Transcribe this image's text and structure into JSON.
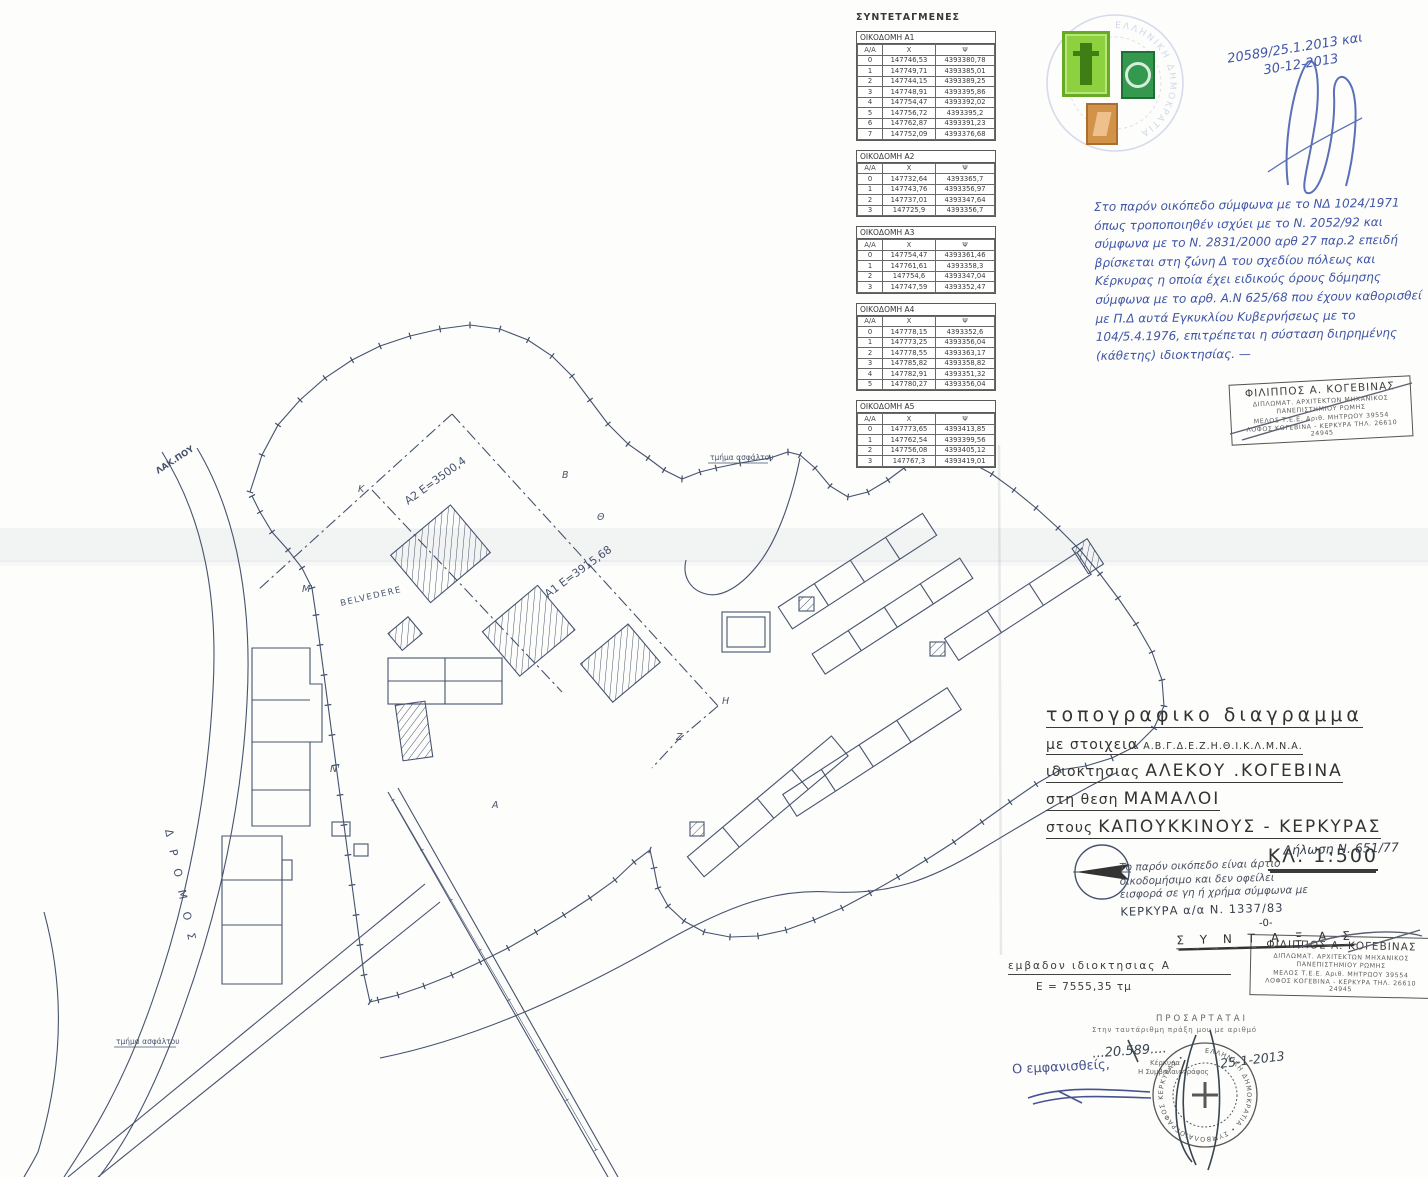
{
  "coordinates_panel": {
    "title": "ΣΥΝΤΕΤΑΓΜΕΝΕΣ",
    "columns": [
      "Α/Α",
      "Χ",
      "Ψ"
    ],
    "tables": [
      {
        "name": "ΟΙΚΟΔΟΜΗ Α1",
        "rows": [
          [
            "0",
            "147746,53",
            "4393380,78"
          ],
          [
            "1",
            "147749,71",
            "4393385,01"
          ],
          [
            "2",
            "147744,15",
            "4393389,25"
          ],
          [
            "3",
            "147748,91",
            "4393395,86"
          ],
          [
            "4",
            "147754,47",
            "4393392,02"
          ],
          [
            "5",
            "147756,72",
            "4393395,2"
          ],
          [
            "6",
            "147762,87",
            "4393391,23"
          ],
          [
            "7",
            "147752,09",
            "4393376,68"
          ]
        ]
      },
      {
        "name": "ΟΙΚΟΔΟΜΗ Α2",
        "rows": [
          [
            "0",
            "147732,64",
            "4393365,7"
          ],
          [
            "1",
            "147743,76",
            "4393356,97"
          ],
          [
            "2",
            "147737,01",
            "4393347,64"
          ],
          [
            "3",
            "147725,9",
            "4393356,7"
          ]
        ]
      },
      {
        "name": "ΟΙΚΟΔΟΜΗ Α3",
        "rows": [
          [
            "0",
            "147754,47",
            "4393361,46"
          ],
          [
            "1",
            "147761,61",
            "4393358,3"
          ],
          [
            "2",
            "147754,6",
            "4393347,04"
          ],
          [
            "3",
            "147747,59",
            "4393352,47"
          ]
        ]
      },
      {
        "name": "ΟΙΚΟΔΟΜΗ Α4",
        "rows": [
          [
            "0",
            "147778,15",
            "4393352,6"
          ],
          [
            "1",
            "147773,25",
            "4393356,04"
          ],
          [
            "2",
            "147778,55",
            "4393363,17"
          ],
          [
            "3",
            "147785,82",
            "4393358,82"
          ],
          [
            "4",
            "147782,91",
            "4393351,32"
          ],
          [
            "5",
            "147780,27",
            "4393356,04"
          ]
        ]
      },
      {
        "name": "ΟΙΚΟΔΟΜΗ Α5",
        "rows": [
          [
            "0",
            "147773,65",
            "4393413,85"
          ],
          [
            "1",
            "147762,54",
            "4393399,56"
          ],
          [
            "2",
            "147756,08",
            "4393405,12"
          ],
          [
            "3",
            "147767,3",
            "4393419,01"
          ]
        ]
      }
    ]
  },
  "annotations": {
    "registry_line1": "20589/25.1.2013 και",
    "registry_line2": "30-12-2013",
    "legal_note_lines": [
      "Στο παρόν οικόπεδο σύμφωνα με το ΝΔ 1024/1971",
      "όπως τροποποιηθέν ισχύει με το Ν. 2052/92 και",
      "σύμφωνα με το Ν. 2831/2000 αρθ 27 παρ.2 επειδή",
      "βρίσκεται στη ζώνη Δ του σχεδίου πόλεως και",
      "Κέρκυρας η οποία έχει ειδικούς όρους δόμησης",
      "σύμφωνα με το αρθ. Α.Ν 625/68 που έχουν καθορισθεί",
      "με Π.Δ αυτά Εγκυκλίου Κυβερνήσεως με το",
      "104/5.4.1976, επιτρέπεται η σύσταση διηρημένης",
      "(κάθετης) ιδιοκτησίας. —"
    ]
  },
  "architect_stamp": {
    "line1": "ΦΙΛΙΠΠΟΣ Α. ΚΟΓΕΒΙΝΑΣ",
    "line2": "ΔΙΠΛΩΜΑΤ. ΑΡΧΙΤΕΚΤΩΝ ΜΗΧΑΝΙΚΟΣ",
    "line3": "ΠΑΝΕΠΙΣΤΗΜΙΟΥ ΡΩΜΗΣ",
    "line4": "ΜΕΛΟΣ Τ.Ε.Ε. Αριθ. ΜΗΤΡΩΟΥ 39554",
    "line5": "ΛΟΦΟΣ ΚΟΓΕΒΙΝΑ - ΚΕΡΚΥΡΑ ΤΗΛ. 26610 24945"
  },
  "title_block": {
    "line1": "τοπογραφικο  διαγραμμα",
    "line2_prefix": "με στοιχεια",
    "line2_letters": "Α.Β.Γ.Δ.Ε.Ζ.Η.Θ.Ι.Κ.Λ.Μ.Ν.Α.",
    "line3_prefix": "ιδιοκτησιας",
    "line3": "ΑΛΕΚΟΥ .ΚΟΓΕΒΙΝΑ",
    "line4_prefix": "στη θεση",
    "line4": "ΜΑΜΑΛΟΙ",
    "line5_prefix": "στους",
    "line5": "ΚΑΠΟΥΚΚΙΝΟΥΣ - ΚΕΡΚΥΡΑΣ",
    "scale": "ΚΛ. 1:500"
  },
  "declaration": {
    "heading": "Δήλωση Ν. 651/77",
    "lines": [
      "Το παρόν οικόπεδο είναι άρτιο",
      "οικοδομήσιμο και δεν οφείλει",
      "εισφορά σε γη ή χρήμα σύμφωνα με"
    ],
    "place_line": "ΚΕΡΚΥΡΑ α/α Ν. 1337/83",
    "separator": "-0-",
    "syntaxas": "Σ Υ Ν Τ Α Ξ Α Σ"
  },
  "area_block": {
    "label": "εμβαδον ιδιοκτησιας  Α",
    "value": "Ε   =   7555,35 τμ"
  },
  "attachment_block": {
    "heading": "ΠΡΟΣΑΡΤΑΤΑΙ",
    "subheading": "Στην ταυτάριθμη πράξη μου με αριθμό",
    "number": "...20.589....",
    "date": "25-1-2013",
    "place": "Κέρκυρα",
    "notary": "Η Συμβολαιογράφος",
    "stamp_ring_text": "ΕΛΛΗΝΙΚΗ ΔΗΜΟΚΡΑΤΙΑ • ΣΥΜΒΟΛΑΙΟΓΡΑΦΟΣ ΚΕΡΚΥΡΑΣ •",
    "appeared": "Ο εμφανισθείς,"
  },
  "plan_labels": {
    "parcel_a2": "Α2   Ε=3500,4",
    "parcel_a1": "Α1   Ε=3915,68",
    "belvedere": "BELVEDERE",
    "asphalt_top": "τμήμα ασφάλτου",
    "asphalt_bottom": "τμήμα ασφάλτου",
    "road": "ΔΡΟΜΟΣ",
    "road_top": "ΛΑΚ.ΠΟΥ",
    "vertices": [
      "Κ",
      "Β",
      "Θ",
      "Η",
      "Ζ",
      "Ν'",
      "Μ'",
      "Α"
    ]
  },
  "colors": {
    "drawing_ink": "#46536e",
    "typed_ink": "#2f2f2f",
    "hand_ink_blue": "#3f55a8",
    "stamp_green_bright": "#8ed13e",
    "stamp_green_dark": "#35984f",
    "stamp_orange": "#d2924a",
    "stamp_blue": "#6b7fc9",
    "paper": "#fdfdfb"
  }
}
